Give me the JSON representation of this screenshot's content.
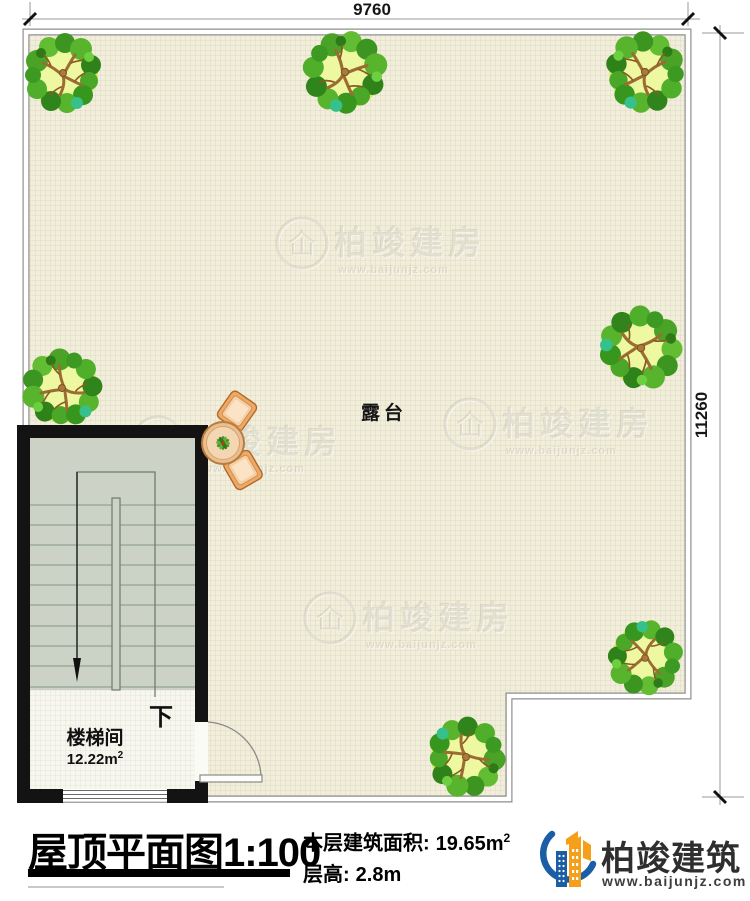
{
  "plan": {
    "dim_top": "9760",
    "dim_right": "11260",
    "terrace_label": "露台",
    "stairwell": {
      "down_label": "下",
      "room_label": "楼梯间",
      "room_area": "12.22m",
      "room_area_sup": "2"
    },
    "watermark": {
      "glyph": "仚",
      "brand": "柏竣建房",
      "url": "www.baijunjz.com"
    }
  },
  "footer": {
    "title": "屋顶平面图1:100",
    "area_label": "本层建筑面积:",
    "area_value": "19.65m",
    "area_sup": "2",
    "height_label": "层高:",
    "height_value": "2.8m",
    "brand_name": "柏竣建筑",
    "brand_url": "www.baijunjz.com"
  },
  "colors": {
    "logo_blue": "#1b5ea6",
    "logo_orange": "#f5a01a",
    "plan_bg": "#f1eedc",
    "grid_line": "#d9d3b2",
    "wall_black": "#131313",
    "stair_fill": "#ccd3c6"
  }
}
